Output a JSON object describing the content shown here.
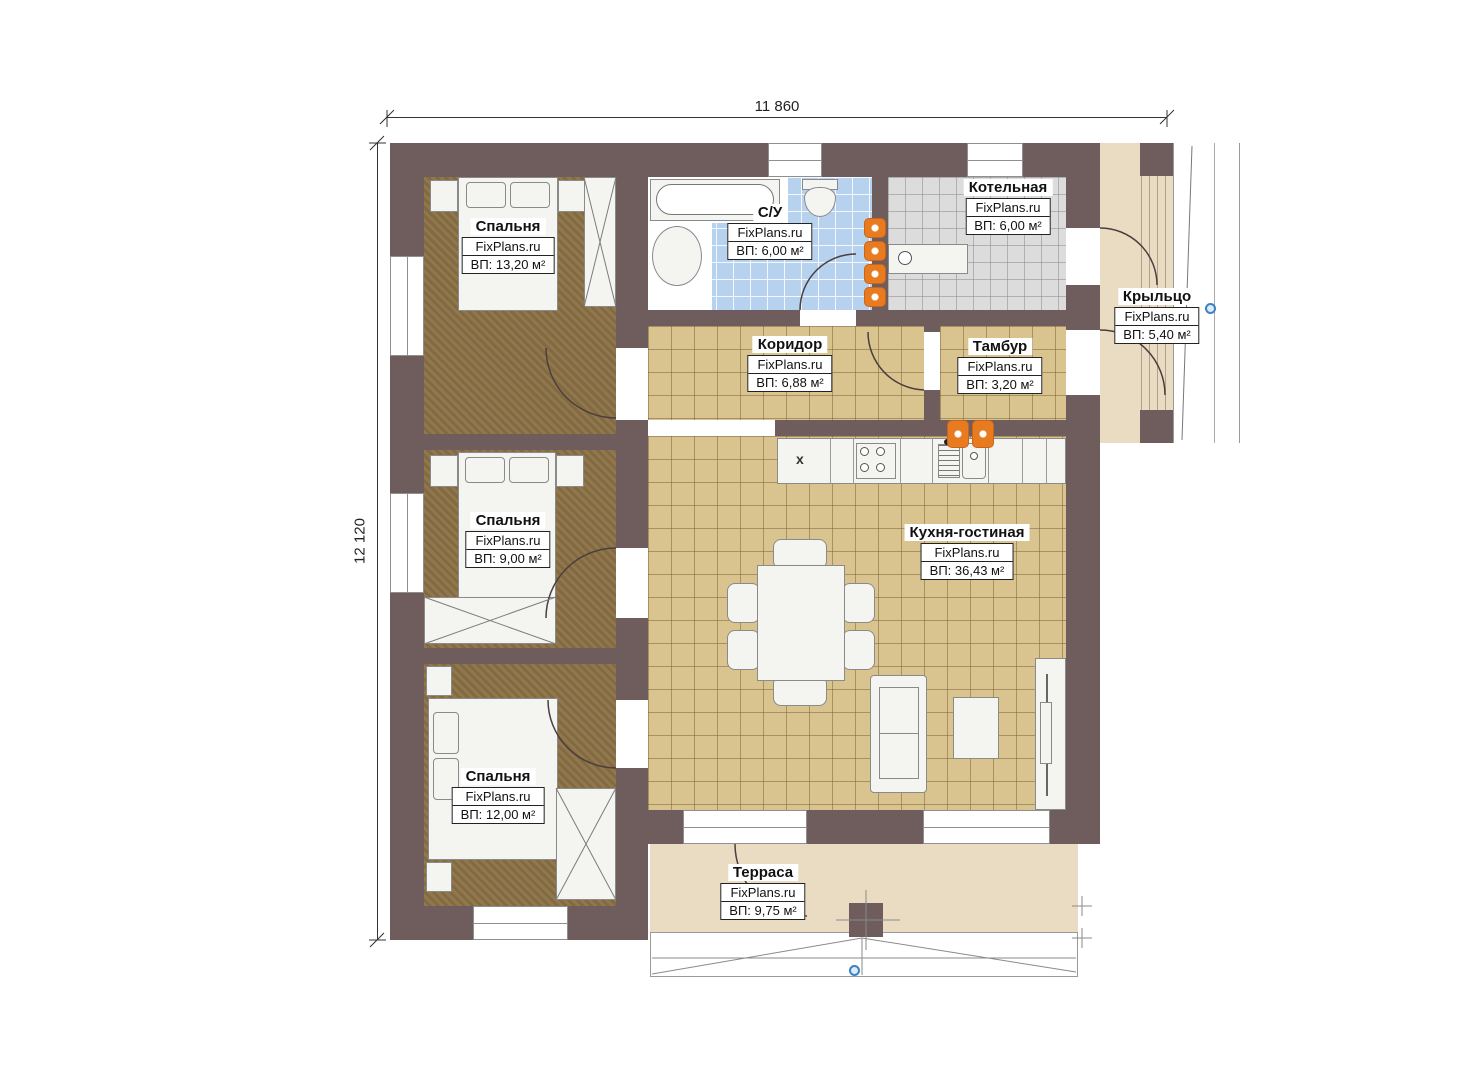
{
  "dimensions": {
    "width": "11 860",
    "height": "12 120"
  },
  "rooms": {
    "bedroom1": {
      "name": "Спальня",
      "brand": "FixPlans.ru",
      "area": "ВП: 13,20 м²"
    },
    "bathroom": {
      "name": "С/У",
      "brand": "FixPlans.ru",
      "area": "ВП: 6,00 м²"
    },
    "boiler": {
      "name": "Котельная",
      "brand": "FixPlans.ru",
      "area": "ВП: 6,00 м²"
    },
    "corridor": {
      "name": "Коридор",
      "brand": "FixPlans.ru",
      "area": "ВП: 6,88 м²"
    },
    "tambour": {
      "name": "Тамбур",
      "brand": "FixPlans.ru",
      "area": "ВП: 3,20 м²"
    },
    "porch": {
      "name": "Крыльцо",
      "brand": "FixPlans.ru",
      "area": "ВП: 5,40 м²"
    },
    "bedroom2": {
      "name": "Спальня",
      "brand": "FixPlans.ru",
      "area": "ВП: 9,00 м²"
    },
    "kitchen_living": {
      "name": "Кухня-гостиная",
      "brand": "FixPlans.ru",
      "area": "ВП: 36,43 м²"
    },
    "bedroom3": {
      "name": "Спальня",
      "brand": "FixPlans.ru",
      "area": "ВП: 12,00 м²"
    },
    "terrace": {
      "name": "Терраса",
      "brand": "FixPlans.ru",
      "area": "ВП: 9,75 м²"
    }
  },
  "fixtures": {
    "kitchen_unit_mark": "x"
  },
  "colors": {
    "wall": "#6f5d5d",
    "carpet": "#8a7045",
    "tile_tan": "#d9c38f",
    "tile_blue": "#b7d2ef",
    "tile_gray": "#dcdcdc",
    "deck": "#e9dcc2",
    "fixture": "#f4f4f1",
    "accent_orange": "#e87b20",
    "marker_blue": "#3b82c4"
  }
}
